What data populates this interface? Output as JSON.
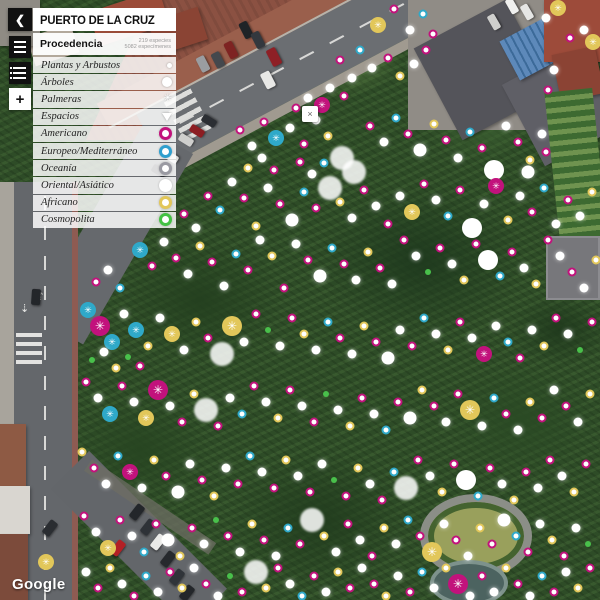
{
  "header": {
    "title": "PUERTO DE LA CRUZ",
    "back_icon": "❮"
  },
  "toolbar": {
    "zoom_in_label": "+"
  },
  "panel": {
    "section_title": "Procedencia",
    "stats": [
      "219 especies",
      "5082 especímenes"
    ],
    "categories": [
      {
        "label": "Plantas y Arbustos",
        "icon": "dot"
      },
      {
        "label": "Árboles",
        "icon": "circle"
      },
      {
        "label": "Palmeras",
        "icon": "asterisk"
      },
      {
        "label": "Espacios",
        "icon": "triangle"
      }
    ],
    "legend": [
      {
        "label": "Americano",
        "color": "#c2127c",
        "style": "ring"
      },
      {
        "label": "Europeo/Mediterráneo",
        "color": "#2f9fce",
        "style": "ring"
      },
      {
        "label": "Oceanía",
        "color": "#9a9aa2",
        "style": "ring"
      },
      {
        "label": "Oriental/Asiático",
        "color": "#ffffff",
        "style": "solid"
      },
      {
        "label": "Africano",
        "color": "#e2c75a",
        "style": "ring"
      },
      {
        "label": "Cosmopolita",
        "color": "#43c243",
        "style": "ring"
      }
    ]
  },
  "map": {
    "attribution": "Google",
    "popup_close": "×",
    "asterisk_glyph": "✳",
    "colors": {
      "M": "#c2127c",
      "C": "#2fa9c9",
      "Y": "#e2c75a",
      "G": "#49c04b",
      "W": "#ffffff",
      "S": "#a9adb4"
    },
    "markers": "378,25,Y,a;394,9,M,d;410,30,W,w;423,14,C,d;433,34,M,d;546,18,W,w;558,8,Y,a;584,30,W,w;593,42,Y,a;570,38,M,d;340,60,M,d;352,78,W,w;344,96,M,d;330,88,W,w;322,105,M,a;308,98,W,w;296,108,M,d;360,50,C,d;372,68,W,w;388,58,M,d;400,76,Y,d;414,64,W,w;426,50,M,d;548,90,M,d;554,70,W,w;240,130,M,d;252,146,W,w;264,122,M,d;276,138,C,a;290,128,W,w;304,144,M,d;316,120,W,w;328,136,Y,d;342,158,W,b;354,172,W,b;370,126,M,d;384,142,W,w;396,118,C,d;408,134,M,d;420,150,W,t;434,124,Y,d;446,140,M,d;458,158,W,w;470,132,C,d;482,148,M,d;494,170,W,A;506,126,W,w;518,142,M,d;530,160,Y,d;542,134,W,w;300,162,M,d;312,174,W,w;324,163,C,d;248,168,Y,d;262,158,W,w;274,170,M,d;528,172,W,t;546,152,M,d;184,214,M,d;196,228,W,w;208,196,M,d;220,210,C,d;232,182,W,w;244,198,M,d;256,226,Y,d;268,188,W,w;280,204,M,d;292,220,W,t;304,192,C,d;316,208,M,d;330,188,W,b;340,202,Y,d;352,218,W,w;364,190,M,d;376,206,W,w;388,224,M,d;400,196,W,w;412,212,Y,a;424,184,M,d;436,200,W,w;448,216,C,d;460,190,M,d;472,228,W,A;484,204,W,w;496,186,M,a;508,220,Y,d;520,196,W,w;532,212,M,d;544,188,C,d;556,224,W,w;568,200,M,d;580,216,W,w;592,192,Y,d;140,250,C,a;152,266,M,d;164,242,W,w;176,258,M,d;188,274,W,w;200,246,Y,d;212,262,M,d;224,286,W,w;236,254,C,d;248,270,M,d;260,240,W,w;272,256,Y,d;284,288,M,d;296,244,W,w;308,260,M,d;320,276,W,t;332,248,C,d;344,264,M,d;356,280,W,w;368,252,Y,d;380,268,M,d;392,284,W,w;404,240,M,d;416,256,W,w;428,272,G,s;440,248,M,d;452,264,W,w;464,280,Y,d;476,244,M,d;488,260,W,A;500,276,C,d;512,252,M,d;524,268,W,w;536,284,Y,d;548,240,M,d;560,256,W,w;572,272,M,d;584,288,W,w;596,260,Y,d;96,282,M,d;108,270,W,w;120,288,C,d;88,310,C,a;100,326,M,A;112,342,C,a;124,314,W,w;136,330,C,a;148,346,Y,d;160,318,W,w;172,334,Y,a;184,350,W,w;196,322,Y,d;208,338,M,d;222,354,W,b;232,326,Y,A;244,342,W,w;256,314,M,d;268,330,G,s;280,346,W,w;292,318,M,d;304,334,Y,d;316,350,W,w;328,322,C,d;340,338,M,d;352,354,W,w;364,326,Y,d;376,342,M,d;388,358,W,t;400,330,W,w;412,346,M,d;424,318,C,d;436,334,W,w;448,350,Y,d;460,322,M,d;472,338,W,w;484,354,M,a;496,326,W,w;508,342,C,d;520,358,M,d;532,330,W,w;544,346,Y,d;556,318,M,d;568,334,W,w;580,350,G,s;592,322,M,d;92,360,G,s;104,352,W,w;116,368,Y,d;128,357,G,s;140,366,M,d;86,382,M,d;98,398,W,w;110,414,C,a;122,386,M,d;134,402,W,w;146,418,Y,a;158,390,M,A;170,406,W,w;182,422,M,d;194,394,Y,d;206,410,W,b;218,426,M,d;230,398,W,w;242,414,C,d;254,386,M,d;266,402,W,w;278,418,Y,d;290,390,M,d;302,406,W,w;314,422,M,d;326,394,G,s;338,410,W,w;350,426,Y,d;362,398,M,d;374,414,W,w;386,430,C,d;398,402,M,d;410,418,W,t;422,390,Y,d;434,406,M,d;446,422,W,w;458,394,M,d;470,410,Y,A;482,426,W,w;494,398,C,d;506,414,M,d;518,430,W,w;530,402,Y,d;542,418,M,d;554,390,W,w;566,406,M,d;578,422,W,w;590,394,Y,d;82,452,Y,d;94,468,M,d;106,484,W,w;118,456,C,d;130,472,M,a;142,488,W,w;154,460,Y,d;166,476,M,d;178,492,W,t;190,464,W,w;202,480,M,d;214,496,Y,d;226,468,W,w;238,484,M,d;250,456,C,d;262,472,W,w;274,488,M,d;286,460,Y,d;298,476,W,w;310,492,M,d;322,464,W,w;334,480,G,s;346,496,M,d;358,468,Y,d;370,484,W,w;382,500,M,d;394,472,C,d;406,488,W,b;418,460,M,d;430,476,W,w;442,492,Y,d;454,464,M,d;466,480,W,A;478,496,C,d;490,468,M,d;502,484,W,w;514,500,Y,d;526,472,M,d;538,488,W,w;550,460,M,d;562,476,W,w;574,492,Y,d;586,464,M,d;84,516,M,d;96,532,W,w;108,548,Y,a;120,520,M,d;132,536,W,w;144,552,C,d;156,524,M,d;168,540,W,t;180,556,Y,d;192,528,M,d;204,544,W,w;216,520,G,s;228,536,M,d;240,552,W,w;252,524,Y,d;264,540,M,d;276,556,W,w;288,528,C,d;300,544,M,d;312,520,W,b;324,536,Y,d;336,552,W,w;348,524,M,d;360,540,W,w;372,556,M,d;384,528,Y,d;396,544,W,w;408,520,C,d;420,536,M,d;432,552,Y,A;444,524,W,w;456,540,M,d;468,556,W,w;480,528,Y,d;492,544,M,d;504,520,W,t;516,536,C,d;528,552,M,d;540,524,W,w;552,540,Y,d;564,556,M,d;576,528,W,w;588,544,G,s;46,562,Y,a;86,572,W,w;98,588,M,d;110,568,Y,d;122,584,W,w;134,596,M,d;146,576,C,d;158,592,W,w;170,572,M,d;182,588,Y,d;194,568,W,w;206,584,M,d;218,596,W,w;230,576,G,s;242,592,M,d;256,572,W,b;266,588,Y,d;278,568,M,d;290,584,W,w;302,596,C,d;314,576,M,d;326,592,W,w;338,572,Y,d;350,588,M,d;362,568,W,w;374,584,M,d;386,596,Y,d;398,576,W,w;410,592,M,d;422,572,C,d;434,588,W,w;446,568,Y,d;458,584,M,A;470,596,W,w;482,576,M,d;494,592,W,w;506,568,Y,d;518,584,M,d;530,596,W,w;542,576,C,d;554,592,M,d;566,572,W,w;578,588,Y,d;590,568,M,d",
    "cars": [
      [
        246,
        30,
        9,
        17,
        -27,
        "#1f2327"
      ],
      [
        258,
        40,
        9,
        17,
        -27,
        "#33383e"
      ],
      [
        231,
        50,
        9,
        17,
        -27,
        "#7e2322"
      ],
      [
        274,
        57,
        10,
        18,
        -27,
        "#8e2026"
      ],
      [
        203,
        64,
        9,
        16,
        -27,
        "#9a9da1"
      ],
      [
        218,
        60,
        9,
        16,
        -27,
        "#44484d"
      ],
      [
        268,
        80,
        10,
        17,
        -27,
        "#e8e8e6"
      ],
      [
        186,
        140,
        8,
        15,
        -58,
        "#cfcfcd"
      ],
      [
        197,
        131,
        8,
        15,
        -58,
        "#8c1d22"
      ],
      [
        209,
        121,
        8,
        15,
        -58,
        "#2b2e33"
      ],
      [
        171,
        157,
        8,
        15,
        -58,
        "#dcdcda"
      ],
      [
        159,
        171,
        8,
        15,
        -58,
        "#2b2e33"
      ],
      [
        36,
        297,
        9,
        16,
        4,
        "#23262a"
      ],
      [
        512,
        6,
        8,
        16,
        -30,
        "#f0f0ee"
      ],
      [
        527,
        12,
        8,
        16,
        -30,
        "#e6e6e4"
      ],
      [
        494,
        22,
        8,
        16,
        -30,
        "#cfcfcd"
      ],
      [
        50,
        528,
        9,
        16,
        38,
        "#2a2d31"
      ],
      [
        137,
        512,
        9,
        16,
        38,
        "#23262a"
      ],
      [
        148,
        527,
        9,
        16,
        38,
        "#2e3237"
      ],
      [
        158,
        542,
        9,
        16,
        38,
        "#e9e9e7"
      ],
      [
        118,
        548,
        9,
        16,
        38,
        "#b32025"
      ],
      [
        168,
        559,
        9,
        16,
        38,
        "#26292d"
      ],
      [
        177,
        577,
        9,
        16,
        38,
        "#303439"
      ],
      [
        187,
        593,
        9,
        16,
        38,
        "#23262a"
      ]
    ]
  }
}
